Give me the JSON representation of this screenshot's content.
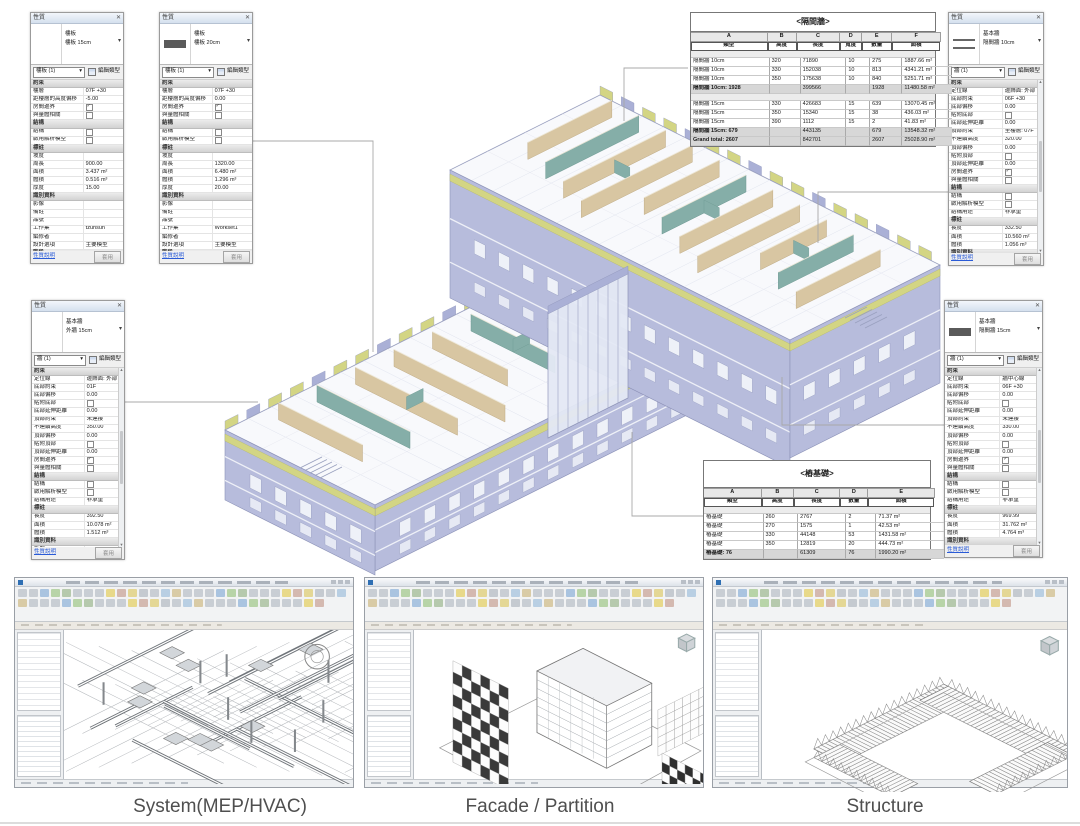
{
  "colors": {
    "accent_link_blue": "#2a5bd7",
    "wall_lavender": "#b0b5d8",
    "partition_tan": "#d8c6a2",
    "partition_teal": "#85aea8",
    "facade_yellow_green": "#d3d584",
    "section_header_gray": "#d2d2d2"
  },
  "palettes": [
    {
      "title": "性質",
      "type_name": "樓板",
      "type_desc": "樓板 15cm",
      "selector_value": "樓板 (1)",
      "edit_type_label": "編輯類型",
      "thumb": "none",
      "help_label": "性質說明",
      "apply_label": "套用",
      "scroll": false,
      "rows": [
        {
          "t": "sec",
          "l": "約束"
        },
        {
          "t": "f",
          "l": "樓層",
          "v": "07F +30"
        },
        {
          "t": "f",
          "l": "距樓層的高度偏移",
          "v": "-5.00"
        },
        {
          "t": "c",
          "l": "房間邊界",
          "ck": true
        },
        {
          "t": "c",
          "l": "與量體相關",
          "ck": false
        },
        {
          "t": "sec",
          "l": "結構"
        },
        {
          "t": "c",
          "l": "結構",
          "ck": false
        },
        {
          "t": "c",
          "l": "啟用解析模型",
          "ck": false
        },
        {
          "t": "sec",
          "l": "標註"
        },
        {
          "t": "f",
          "l": "坡度",
          "v": ""
        },
        {
          "t": "f",
          "l": "周長",
          "v": "900.00"
        },
        {
          "t": "f",
          "l": "面積",
          "v": "3.437 m²"
        },
        {
          "t": "f",
          "l": "體積",
          "v": "0.516 m³"
        },
        {
          "t": "f",
          "l": "厚度",
          "v": "15.00"
        },
        {
          "t": "sec",
          "l": "識別資料"
        },
        {
          "t": "f",
          "l": "影像",
          "v": ""
        },
        {
          "t": "f",
          "l": "備註",
          "v": ""
        },
        {
          "t": "f",
          "l": "品號",
          "v": ""
        },
        {
          "t": "f",
          "l": "工作集",
          "v": "tzuhsun"
        },
        {
          "t": "f",
          "l": "編修者",
          "v": ""
        },
        {
          "t": "f",
          "l": "設計選項",
          "v": "主要模型"
        },
        {
          "t": "sec",
          "l": "階段"
        },
        {
          "t": "f",
          "l": "建立階段",
          "v": "New Construc...",
          "b": true
        },
        {
          "t": "f",
          "l": "拆除階段",
          "v": "無"
        }
      ]
    },
    {
      "title": "性質",
      "type_name": "樓板",
      "type_desc": "樓板 20cm",
      "selector_value": "樓板 (1)",
      "edit_type_label": "編輯類型",
      "thumb": "bar",
      "help_label": "性質說明",
      "apply_label": "套用",
      "scroll": false,
      "rows": [
        {
          "t": "sec",
          "l": "約束"
        },
        {
          "t": "f",
          "l": "樓層",
          "v": "07F +30"
        },
        {
          "t": "f",
          "l": "距樓層的高度偏移",
          "v": "0.00"
        },
        {
          "t": "c",
          "l": "房間邊界",
          "ck": true
        },
        {
          "t": "c",
          "l": "與量體相關",
          "ck": false
        },
        {
          "t": "sec",
          "l": "結構"
        },
        {
          "t": "c",
          "l": "結構",
          "ck": false
        },
        {
          "t": "c",
          "l": "啟用解析模型",
          "ck": false
        },
        {
          "t": "sec",
          "l": "標註"
        },
        {
          "t": "f",
          "l": "坡度",
          "v": ""
        },
        {
          "t": "f",
          "l": "周長",
          "v": "1320.00"
        },
        {
          "t": "f",
          "l": "面積",
          "v": "6.480 m²"
        },
        {
          "t": "f",
          "l": "體積",
          "v": "1.296 m³"
        },
        {
          "t": "f",
          "l": "厚度",
          "v": "20.00"
        },
        {
          "t": "sec",
          "l": "識別資料"
        },
        {
          "t": "f",
          "l": "影像",
          "v": ""
        },
        {
          "t": "f",
          "l": "備註",
          "v": ""
        },
        {
          "t": "f",
          "l": "品號",
          "v": ""
        },
        {
          "t": "f",
          "l": "工作集",
          "v": "Workset1"
        },
        {
          "t": "f",
          "l": "編修者",
          "v": ""
        },
        {
          "t": "f",
          "l": "設計選項",
          "v": "主要模型"
        },
        {
          "t": "sec",
          "l": "階段"
        },
        {
          "t": "f",
          "l": "建立階段",
          "v": "New Construc...",
          "b": true
        },
        {
          "t": "f",
          "l": "拆除階段",
          "v": "無"
        }
      ]
    },
    {
      "title": "性質",
      "type_name": "基本牆",
      "type_desc": "外牆 15cm",
      "selector_value": "牆 (1)",
      "edit_type_label": "編輯類型",
      "thumb": "none",
      "help_label": "性質說明",
      "apply_label": "套用",
      "scroll": true,
      "rows": [
        {
          "t": "sec",
          "l": "約束"
        },
        {
          "t": "f",
          "l": "定位線",
          "v": "邊飾面: 外部"
        },
        {
          "t": "f",
          "l": "底部約束",
          "v": "01F"
        },
        {
          "t": "f",
          "l": "底部偏移",
          "v": "0.00"
        },
        {
          "t": "c",
          "l": "貼附底部",
          "ck": false
        },
        {
          "t": "f",
          "l": "底部延伸距離",
          "v": "0.00"
        },
        {
          "t": "f",
          "l": "頂部約束",
          "v": "未連接"
        },
        {
          "t": "f",
          "l": "不連續高度",
          "v": "350.00"
        },
        {
          "t": "f",
          "l": "頂部偏移",
          "v": "0.00"
        },
        {
          "t": "c",
          "l": "貼附頂部",
          "ck": false
        },
        {
          "t": "f",
          "l": "頂部延伸距離",
          "v": "0.00"
        },
        {
          "t": "c",
          "l": "房間邊界",
          "ck": true
        },
        {
          "t": "c",
          "l": "與量體相關",
          "ck": false
        },
        {
          "t": "sec",
          "l": "結構"
        },
        {
          "t": "c",
          "l": "結構",
          "ck": false
        },
        {
          "t": "c",
          "l": "啟用解析模型",
          "ck": false
        },
        {
          "t": "f",
          "l": "結構用途",
          "v": "非承重"
        },
        {
          "t": "sec",
          "l": "標註"
        },
        {
          "t": "f",
          "l": "長度",
          "v": "392.50"
        },
        {
          "t": "f",
          "l": "面積",
          "v": "10.078 m²"
        },
        {
          "t": "f",
          "l": "體積",
          "v": "1.512 m³"
        },
        {
          "t": "sec",
          "l": "識別資料"
        },
        {
          "t": "f",
          "l": "影像",
          "v": ""
        },
        {
          "t": "f",
          "l": "備註",
          "v": ""
        },
        {
          "t": "f",
          "l": "品號",
          "v": "",
          "b": true
        },
        {
          "t": "f",
          "l": "工作集",
          "v": "Workset1"
        }
      ]
    },
    {
      "title": "性質",
      "type_name": "基本牆",
      "type_desc": "隔間牆 10cm",
      "selector_value": "牆 (1)",
      "edit_type_label": "編輯類型",
      "thumb": "lines",
      "help_label": "性質說明",
      "apply_label": "套用",
      "scroll": true,
      "rows": [
        {
          "t": "sec",
          "l": "約束"
        },
        {
          "t": "f",
          "l": "定位線",
          "v": "邊飾面: 外部"
        },
        {
          "t": "f",
          "l": "底部約束",
          "v": "06F +30"
        },
        {
          "t": "f",
          "l": "底部偏移",
          "v": "0.00"
        },
        {
          "t": "c",
          "l": "貼附底部",
          "ck": false
        },
        {
          "t": "f",
          "l": "底部延伸距離",
          "v": "0.00"
        },
        {
          "t": "f",
          "l": "頂部約束",
          "v": "至樓層: 07F"
        },
        {
          "t": "f",
          "l": "不連續高度",
          "v": "320.00"
        },
        {
          "t": "f",
          "l": "頂部偏移",
          "v": "0.00"
        },
        {
          "t": "c",
          "l": "貼附頂部",
          "ck": false
        },
        {
          "t": "f",
          "l": "頂部延伸距離",
          "v": "0.00"
        },
        {
          "t": "c",
          "l": "房間邊界",
          "ck": true
        },
        {
          "t": "c",
          "l": "與量體相關",
          "ck": false
        },
        {
          "t": "sec",
          "l": "結構"
        },
        {
          "t": "c",
          "l": "結構",
          "ck": false
        },
        {
          "t": "c",
          "l": "啟用解析模型",
          "ck": false
        },
        {
          "t": "f",
          "l": "結構用途",
          "v": "非承重"
        },
        {
          "t": "sec",
          "l": "標註"
        },
        {
          "t": "f",
          "l": "長度",
          "v": "332.50"
        },
        {
          "t": "f",
          "l": "面積",
          "v": "10.560 m²"
        },
        {
          "t": "f",
          "l": "體積",
          "v": "1.056 m³"
        },
        {
          "t": "sec",
          "l": "識別資料"
        },
        {
          "t": "f",
          "l": "影像",
          "v": ""
        },
        {
          "t": "f",
          "l": "備註",
          "v": ""
        },
        {
          "t": "f",
          "l": "品號",
          "v": "",
          "b": true
        },
        {
          "t": "f",
          "l": "工作集",
          "v": "tzuhsun"
        }
      ]
    },
    {
      "title": "性質",
      "type_name": "基本牆",
      "type_desc": "隔間牆 15cm",
      "selector_value": "牆 (1)",
      "edit_type_label": "編輯類型",
      "thumb": "bar",
      "help_label": "性質說明",
      "apply_label": "套用",
      "scroll": true,
      "rows": [
        {
          "t": "sec",
          "l": "約束"
        },
        {
          "t": "f",
          "l": "定位線",
          "v": "牆中心線"
        },
        {
          "t": "f",
          "l": "底部約束",
          "v": "06F +30"
        },
        {
          "t": "f",
          "l": "底部偏移",
          "v": "0.00"
        },
        {
          "t": "c",
          "l": "貼附底部",
          "ck": false
        },
        {
          "t": "f",
          "l": "底部延伸距離",
          "v": "0.00"
        },
        {
          "t": "f",
          "l": "頂部約束",
          "v": "未連接"
        },
        {
          "t": "f",
          "l": "不連續高度",
          "v": "330.00"
        },
        {
          "t": "f",
          "l": "頂部偏移",
          "v": "0.00"
        },
        {
          "t": "c",
          "l": "貼附頂部",
          "ck": false
        },
        {
          "t": "f",
          "l": "頂部延伸距離",
          "v": "0.00"
        },
        {
          "t": "c",
          "l": "房間邊界",
          "ck": true
        },
        {
          "t": "c",
          "l": "與量體相關",
          "ck": false
        },
        {
          "t": "sec",
          "l": "結構"
        },
        {
          "t": "c",
          "l": "結構",
          "ck": false
        },
        {
          "t": "c",
          "l": "啟用解析模型",
          "ck": false
        },
        {
          "t": "f",
          "l": "結構用途",
          "v": "非承重"
        },
        {
          "t": "sec",
          "l": "標註"
        },
        {
          "t": "f",
          "l": "長度",
          "v": "969.99"
        },
        {
          "t": "f",
          "l": "面積",
          "v": "31.762 m²"
        },
        {
          "t": "f",
          "l": "體積",
          "v": "4.764 m³"
        },
        {
          "t": "sec",
          "l": "識別資料"
        },
        {
          "t": "f",
          "l": "影像",
          "v": ""
        },
        {
          "t": "f",
          "l": "備註",
          "v": ""
        },
        {
          "t": "f",
          "l": "品號",
          "v": "",
          "b": true
        },
        {
          "t": "f",
          "l": "工作集",
          "v": "Workset1"
        }
      ]
    }
  ],
  "schedules": [
    {
      "title": "<隔間牆>",
      "letters": [
        "A",
        "B",
        "C",
        "D",
        "E",
        "F"
      ],
      "headers": [
        "類型",
        "高度",
        "長度",
        "寬度",
        "數量",
        "面積"
      ],
      "widths": [
        31,
        11.5,
        17.5,
        8.5,
        12,
        19.5
      ],
      "rows": [
        {
          "s": "b"
        },
        {
          "s": "d",
          "c": [
            "隔間牆 10cm",
            "320",
            "71890",
            "10",
            "275",
            "1887.66 m²"
          ]
        },
        {
          "s": "d",
          "c": [
            "隔間牆 10cm",
            "330",
            "152038",
            "10",
            "813",
            "4341.21 m²"
          ]
        },
        {
          "s": "d",
          "c": [
            "隔間牆 10cm",
            "350",
            "175638",
            "10",
            "840",
            "5251.71 m²"
          ]
        },
        {
          "s": "subtotal",
          "c": [
            "隔間牆 10cm: 1928",
            "",
            "399566",
            "",
            "1928",
            "11480.58 m²"
          ]
        },
        {
          "s": "b"
        },
        {
          "s": "d",
          "c": [
            "隔間牆 15cm",
            "330",
            "426683",
            "15",
            "639",
            "13070.45 m²"
          ]
        },
        {
          "s": "d",
          "c": [
            "隔間牆 15cm",
            "350",
            "15340",
            "15",
            "38",
            "436.03 m²"
          ]
        },
        {
          "s": "d",
          "c": [
            "隔間牆 15cm",
            "390",
            "1112",
            "15",
            "2",
            "41.83 m²"
          ]
        },
        {
          "s": "subtotal",
          "c": [
            "隔間牆 15cm: 679",
            "",
            "443135",
            "",
            "679",
            "13548.32 m²"
          ]
        },
        {
          "s": "grand",
          "c": [
            "Grand total: 2607",
            "",
            "842701",
            "",
            "2607",
            "25028.90 m²"
          ]
        }
      ]
    },
    {
      "title": "<樁基礎>",
      "letters": [
        "A",
        "B",
        "C",
        "D",
        "E"
      ],
      "headers": [
        "類型",
        "高度",
        "長度",
        "數量",
        "面積"
      ],
      "widths": [
        25,
        14,
        20,
        12,
        29
      ],
      "rows": [
        {
          "s": "b"
        },
        {
          "s": "d",
          "c": [
            "樁基礎",
            "260",
            "2767",
            "2",
            "71.37 m²"
          ]
        },
        {
          "s": "d",
          "c": [
            "樁基礎",
            "270",
            "1575",
            "1",
            "42.53 m²"
          ]
        },
        {
          "s": "d",
          "c": [
            "樁基礎",
            "330",
            "44148",
            "53",
            "1431.58 m²"
          ]
        },
        {
          "s": "d",
          "c": [
            "樁基礎",
            "350",
            "12819",
            "20",
            "444.73 m²"
          ]
        },
        {
          "s": "grand",
          "c": [
            "樁基礎: 76",
            "",
            "61309",
            "76",
            "1990.20 m²"
          ]
        }
      ]
    }
  ],
  "captions": {
    "left": "System(MEP/HVAC)",
    "middle": "Facade / Partition",
    "right": "Structure"
  }
}
